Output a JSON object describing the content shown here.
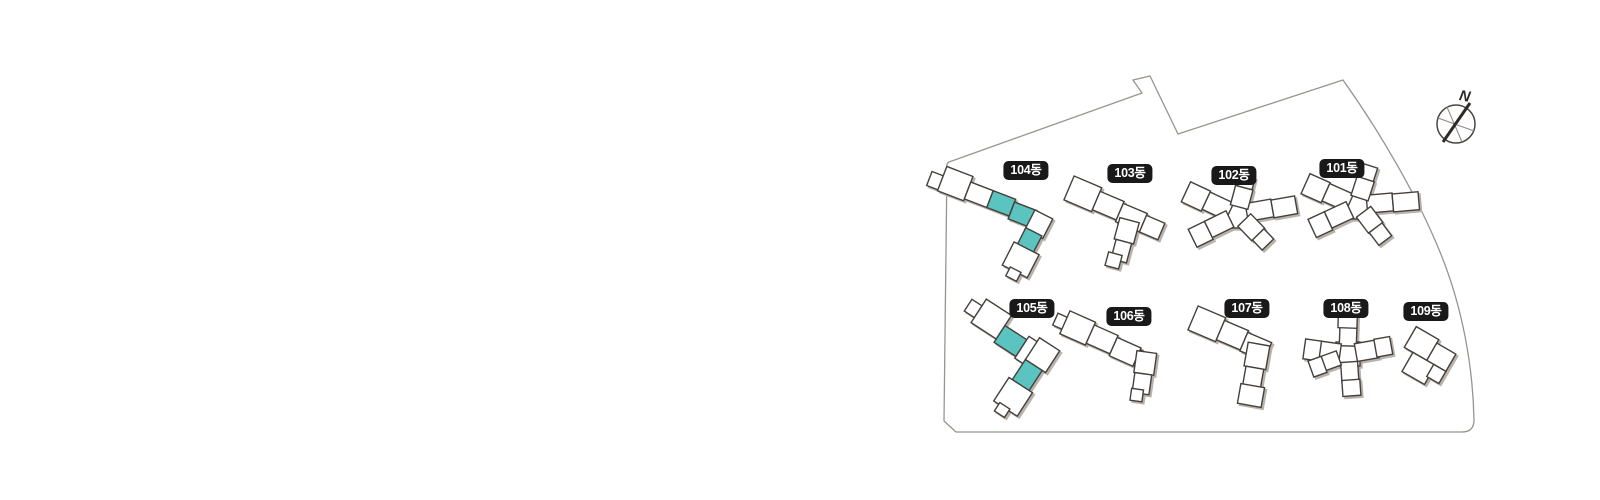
{
  "view": {
    "background": "#ffffff"
  },
  "compass": {
    "label": "N"
  },
  "colors": {
    "highlight_unit": "#5bc4c0",
    "building_outline": "#45403c",
    "building_shadow": "#b9b2ab",
    "boundary_line": "#9a948e",
    "label_background": "#191919",
    "label_text": "#ffffff"
  },
  "buildings": [
    {
      "id": "104",
      "label": "104동",
      "highlighted_units": 3
    },
    {
      "id": "103",
      "label": "103동",
      "highlighted_units": 0
    },
    {
      "id": "102",
      "label": "102동",
      "highlighted_units": 0
    },
    {
      "id": "101",
      "label": "101동",
      "highlighted_units": 0
    },
    {
      "id": "105",
      "label": "105동",
      "highlighted_units": 2
    },
    {
      "id": "106",
      "label": "106동",
      "highlighted_units": 0
    },
    {
      "id": "107",
      "label": "107동",
      "highlighted_units": 0
    },
    {
      "id": "108",
      "label": "108동",
      "highlighted_units": 0
    },
    {
      "id": "109",
      "label": "109동",
      "highlighted_units": 0
    }
  ]
}
